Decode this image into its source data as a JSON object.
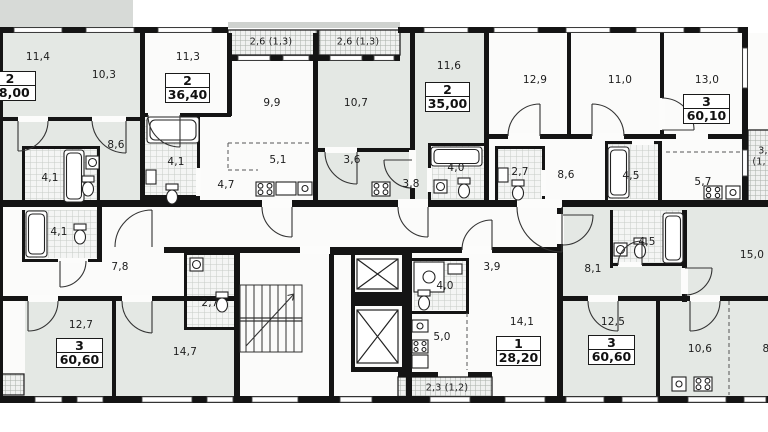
{
  "floor_plan": {
    "type": "residential-floor-plan",
    "apartments": [
      {
        "rooms_count": "2",
        "total_area": "48,00",
        "room_areas": [
          "11,4",
          "10,3",
          "8,6",
          "4,1"
        ]
      },
      {
        "rooms_count": "2",
        "total_area": "36,40",
        "room_areas": [
          "11,3",
          "9,9",
          "5,1",
          "4,7",
          "4,1"
        ],
        "balcony_area": "2,6 (1,3)"
      },
      {
        "rooms_count": "2",
        "total_area": "35,00",
        "room_areas": [
          "10,7",
          "11,6",
          "3,6",
          "3,8",
          "4,0"
        ],
        "balcony_area": "2,6 (1,3)"
      },
      {
        "rooms_count": "3",
        "total_area": "60,10",
        "room_areas": [
          "12,9",
          "11,0",
          "13,0",
          "8,6",
          "4,5",
          "5,7",
          "2,7"
        ]
      },
      {
        "rooms_count": "3",
        "total_area": "60,60",
        "room_areas": [
          "7,8",
          "12,7",
          "14,7",
          "4,1",
          "2,7"
        ]
      },
      {
        "rooms_count": "1",
        "total_area": "28,20",
        "room_areas": [
          "14,1",
          "5,0",
          "4,0",
          "3,9"
        ],
        "balcony_area": "2,3 (1,2)"
      },
      {
        "rooms_count": "3",
        "total_area": "60,60",
        "room_areas": [
          "8,1",
          "12,5",
          "10,6",
          "15,0",
          "4,5"
        ]
      }
    ],
    "clipped_labels": {
      "balcony_right_line1": "3,",
      "balcony_right_line2": "(1,",
      "room_right": "8"
    }
  }
}
